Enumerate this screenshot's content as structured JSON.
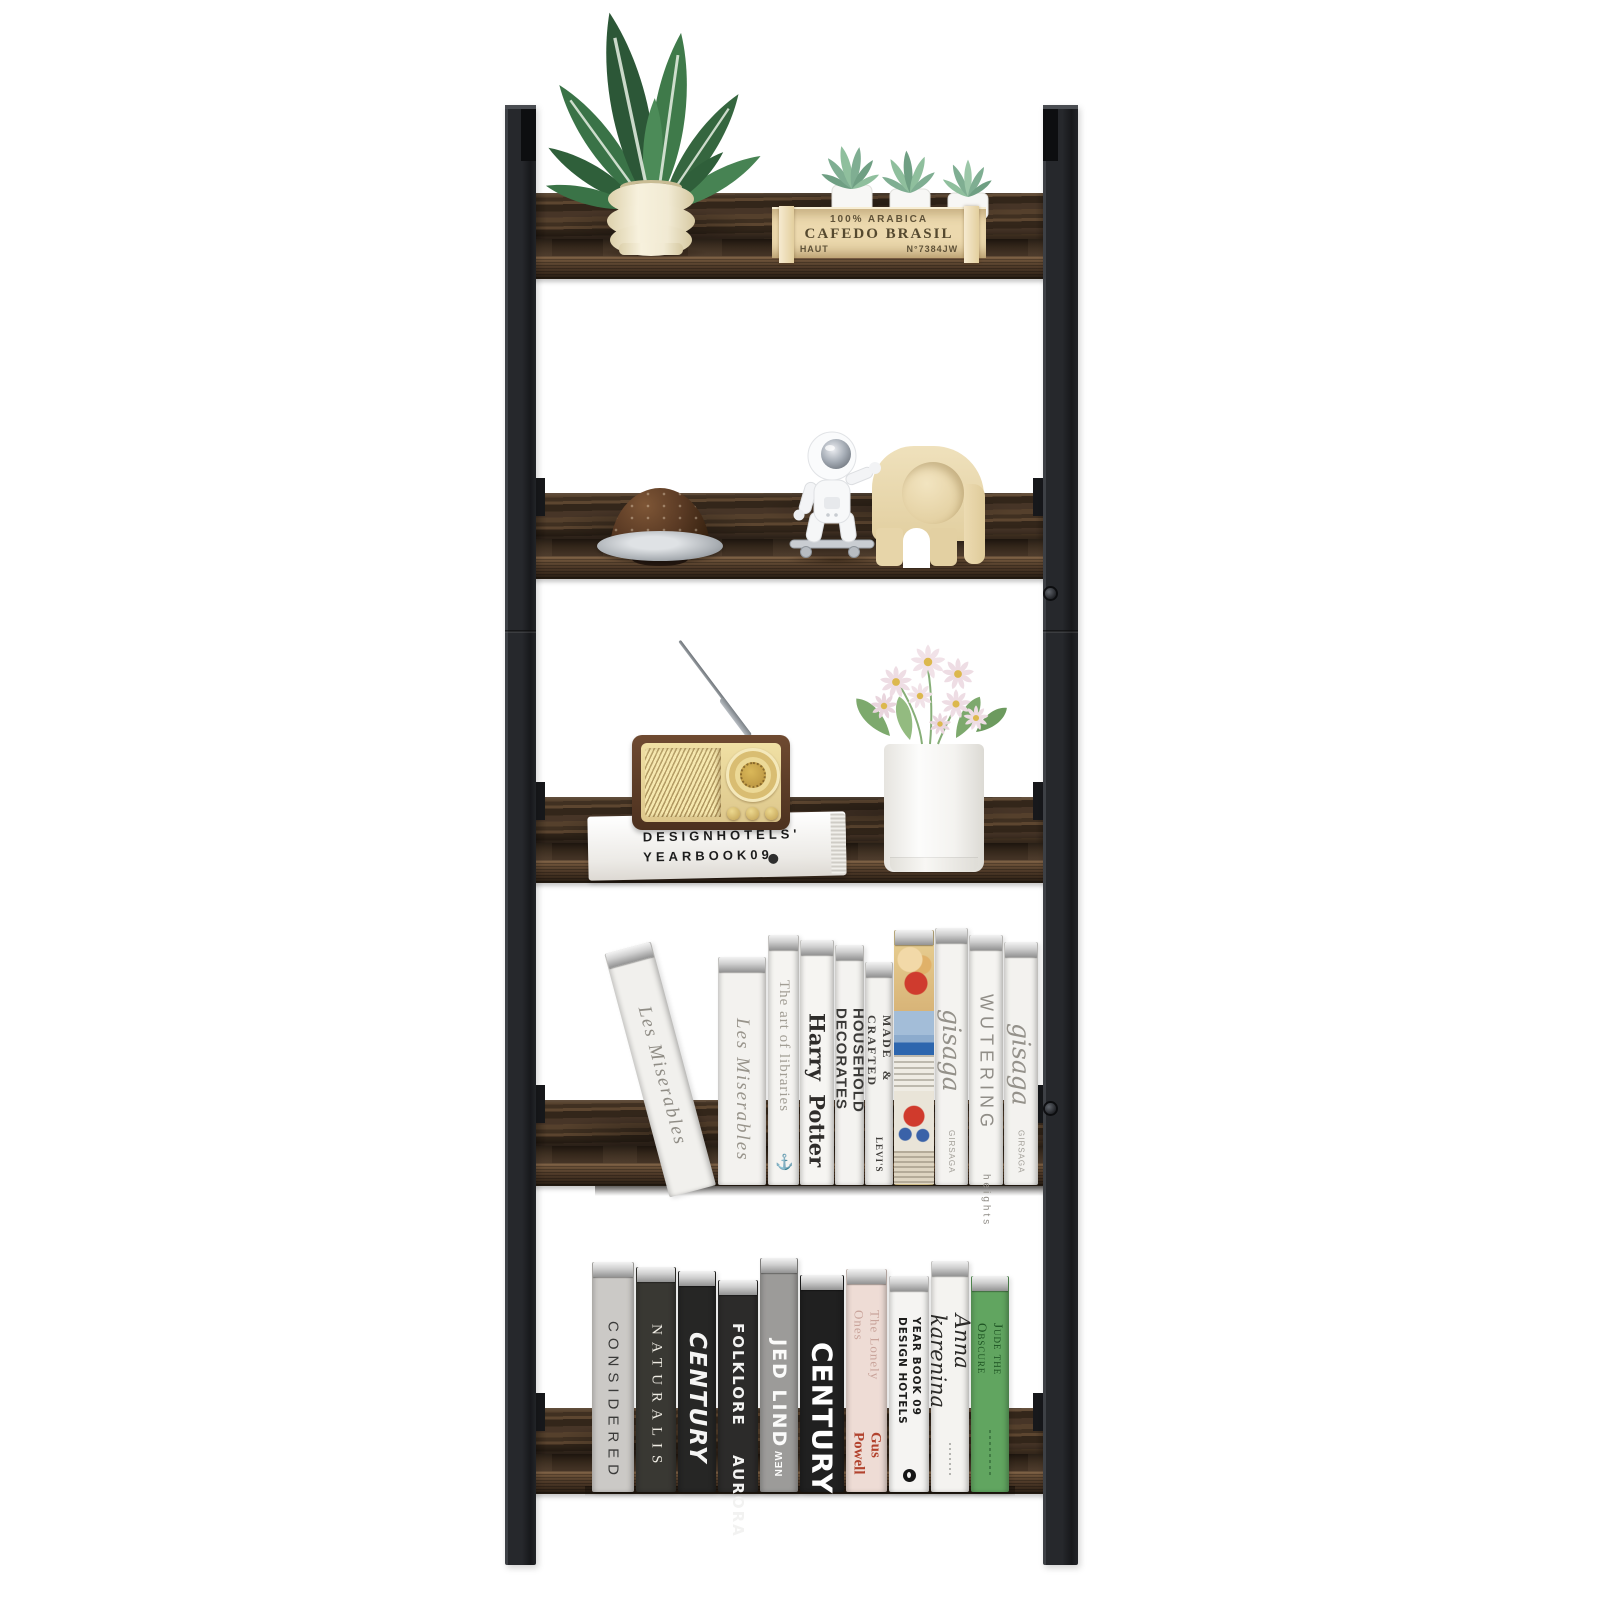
{
  "palette": {
    "post": "#26282b",
    "wood-back": "#403021",
    "wood-front": "#503b29",
    "page-top": "#cfcfcf",
    "crate-wood": "#ecd9ae",
    "elephant": "#e7d5a9",
    "radio-face": "#ead9a6",
    "jude-green": "#61a560"
  },
  "crate": {
    "line1": "100% ARABICA",
    "line2": "CAFEDO BRASIL",
    "line3_left": "HAUT",
    "line3_right": "N°7384JW"
  },
  "yearbook": {
    "line1": "DESIGNHOTELS'",
    "line2": "YEARBOOK09"
  },
  "shelf4_books": [
    {
      "name": "les-miserables-leaning",
      "title": "Les Miserables",
      "style": "serifit",
      "spine": "#f1f0ed",
      "ink": "#8f8c85",
      "x": 668,
      "w": 48,
      "h": 252,
      "lean": -15
    },
    {
      "name": "les-miserables",
      "title": "Les Miserables",
      "style": "serifit",
      "spine": "#f3f2ef",
      "ink": "#98948b",
      "x": 718,
      "w": 48,
      "h": 228
    },
    {
      "name": "the-art-of-libraries",
      "title": "The art of libraries",
      "footer": "⚓",
      "style": "serifsm",
      "spine": "#f5f4f1",
      "ink": "#a29e95",
      "x": 768,
      "w": 31,
      "h": 250
    },
    {
      "name": "harry-potter",
      "title": "Harry Potter",
      "style": "potter",
      "spine": "#f6f5f2",
      "ink": "#2f2d2b",
      "x": 800,
      "w": 34,
      "h": 245
    },
    {
      "name": "household-decorates",
      "title": "HOUSEHOLD DECORATES",
      "style": "cond",
      "spine": "#f4f3f0",
      "ink": "#3b3a38",
      "x": 835,
      "w": 29,
      "h": 240
    },
    {
      "name": "made-and-crafted",
      "title": "MADE & CRAFTED",
      "footer": "LEVI'S",
      "style": "serifxs",
      "spine": "#f3f2ef",
      "ink": "#413f3c",
      "x": 865,
      "w": 28,
      "h": 223
    },
    {
      "name": "comic-collage",
      "style": "comic",
      "spine": "#e3cf96",
      "x": 894,
      "w": 40,
      "h": 255
    },
    {
      "name": "gisaga-1",
      "title": "gisaga",
      "footer": "GIRSAGA",
      "style": "script",
      "spine": "#f4f3f0",
      "ink": "#94918a",
      "x": 935,
      "w": 33,
      "h": 257
    },
    {
      "name": "wutering-heights",
      "title": "WUTERING",
      "subtitle": "heights",
      "style": "wuter",
      "spine": "#f5f4f1",
      "ink": "#908d87",
      "x": 969,
      "w": 34,
      "h": 250
    },
    {
      "name": "gisaga-2",
      "title": "gisaga",
      "footer": "GIRSAGA",
      "style": "script",
      "spine": "#f3f2ef",
      "ink": "#94918a",
      "x": 1004,
      "w": 34,
      "h": 243
    }
  ],
  "shelf5_books": [
    {
      "name": "considered",
      "title": "CONSIDERED",
      "style": "sansls",
      "spine": "#cbc9c6",
      "ink": "#3a3a39",
      "x": 592,
      "w": 42,
      "h": 230
    },
    {
      "name": "naturalis",
      "title": "NATURALIS",
      "style": "serifls",
      "spine": "#393833",
      "ink": "#eeebe3",
      "x": 636,
      "w": 40,
      "h": 225
    },
    {
      "name": "century-small",
      "title": "CENTURY",
      "style": "boldit",
      "spine": "#262625",
      "ink": "#f4f4f3",
      "x": 678,
      "w": 38,
      "h": 221
    },
    {
      "name": "folklore-aurora",
      "title": "FOLKLORE",
      "subtitle": "AURORA",
      "style": "boldtwo",
      "spine": "#2c2b2a",
      "ink": "#f2f2f1",
      "x": 718,
      "w": 40,
      "h": 212
    },
    {
      "name": "jed-lind",
      "title": "JED LIND",
      "footer": "NEW",
      "style": "boldgray",
      "spine": "#9c9b99",
      "ink": "#fbfbfa",
      "x": 760,
      "w": 38,
      "h": 234
    },
    {
      "name": "century-large",
      "title": "CENTURY",
      "style": "xbold",
      "spine": "#202020",
      "ink": "#ffffff",
      "x": 800,
      "w": 44,
      "h": 217
    },
    {
      "name": "the-lonely-ones",
      "title": "The Lonely Ones",
      "footer": "Gus Powell",
      "style": "lonely",
      "spine": "#eedcd5",
      "ink": "#c9a49b",
      "accent": "#b2432e",
      "x": 846,
      "w": 41,
      "h": 223
    },
    {
      "name": "design-hotels-yearbook",
      "title": "DESIGN HOTELS",
      "subtitle": "YEAR BOOK 09",
      "style": "dh",
      "spine": "#f5f4f2",
      "ink": "#1d1d1c",
      "x": 889,
      "w": 40,
      "h": 216
    },
    {
      "name": "anna-karenina",
      "title": "Anna karenina",
      "style": "anna",
      "spine": "#f4f3f0",
      "ink": "#2b2a28",
      "x": 931,
      "w": 38,
      "h": 231
    },
    {
      "name": "jude-the-obscure",
      "title": "Jude the Obscure",
      "style": "jude",
      "spine": "#61a560",
      "ink": "#1d5222",
      "x": 971,
      "w": 38,
      "h": 216
    }
  ]
}
